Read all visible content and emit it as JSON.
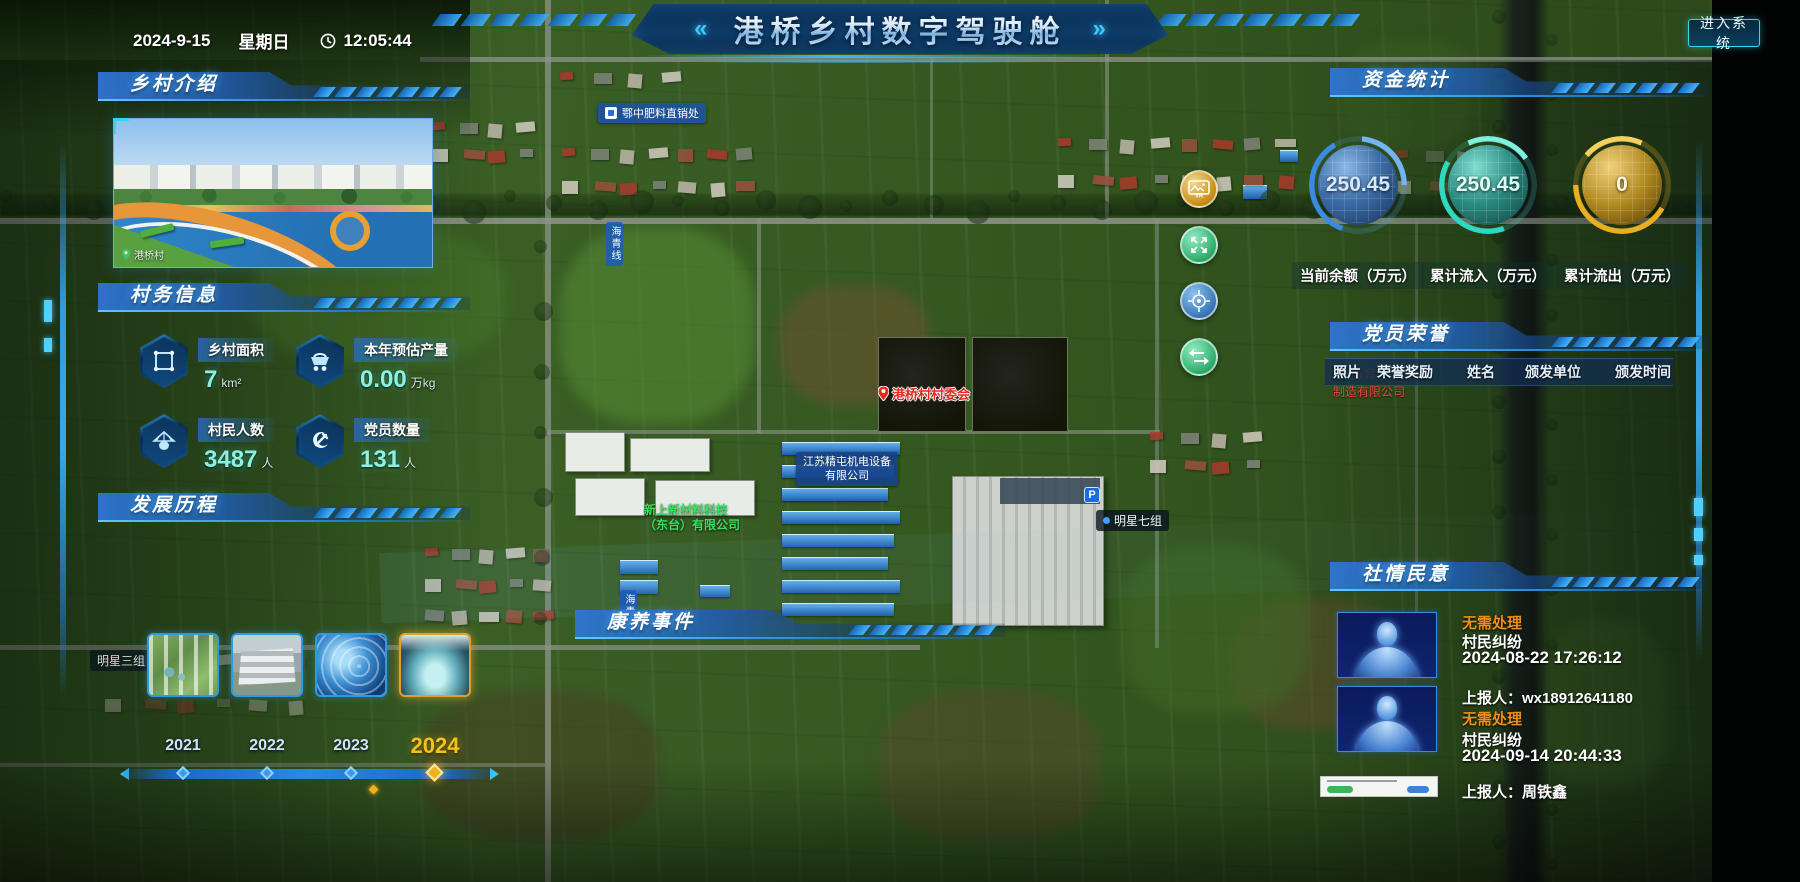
{
  "header": {
    "date": "2024-9-15",
    "weekday": "星期日",
    "time": "12:05:44",
    "title": "港桥乡村数字驾驶舱",
    "title_left_arrow": "«",
    "title_right_arrow": "»",
    "enter_button": "进入系统"
  },
  "panels": {
    "village_intro": {
      "title": "乡村介绍",
      "photo_caption": "港桥村"
    },
    "village_info": {
      "title": "村务信息",
      "stats": [
        {
          "icon": "area-icon",
          "label": "乡村面积",
          "value": "7",
          "unit": "km²"
        },
        {
          "icon": "cart-icon",
          "label": "本年预估产量",
          "value": "0.00",
          "unit": "万kg"
        },
        {
          "icon": "villager-icon",
          "label": "村民人数",
          "value": "3487",
          "unit": "人"
        },
        {
          "icon": "party-icon",
          "label": "党员数量",
          "value": "131",
          "unit": "人"
        }
      ]
    },
    "development": {
      "title": "发展历程",
      "years": [
        {
          "label": "2021",
          "active": false
        },
        {
          "label": "2022",
          "active": false
        },
        {
          "label": "2023",
          "active": false
        },
        {
          "label": "2024",
          "active": true
        }
      ]
    },
    "funds": {
      "title": "资金统计",
      "gauges": [
        {
          "value": "250.45",
          "label": "当前余额（万元）",
          "color": "#3a8ae0"
        },
        {
          "value": "250.45",
          "label": "累计流入（万元）",
          "color": "#2fd8c0"
        },
        {
          "value": "0",
          "label": "累计流出（万元）",
          "color": "#e8b020"
        }
      ]
    },
    "party_honor": {
      "title": "党员荣誉",
      "columns": [
        "照片",
        "荣誉奖励",
        "姓名",
        "颁发单位",
        "颁发时间"
      ]
    },
    "sentiment": {
      "title": "社情民意",
      "items": [
        {
          "status": "无需处理",
          "type": "村民纠纷",
          "time": "2024-08-22 17:26:12",
          "reporter": "上报人：wx18912641180"
        },
        {
          "status": "无需处理",
          "type": "村民纠纷",
          "time": "2024-09-14 20:44:33",
          "reporter": "上报人：周铁鑫"
        }
      ]
    },
    "health_events": {
      "title": "康养事件"
    }
  },
  "map": {
    "poi": {
      "fertilizer_store": "鄂中肥料直销处",
      "village_committee": "港桥村村委会",
      "company_jingtun_line1": "江苏精屯机电设备",
      "company_jingtun_line2": "有限公司",
      "company_xinshang_line1": "新上新材料科技",
      "company_xinshang_line2": "（东台）有限公司",
      "mingxing7": "明星七组",
      "mingxing3": "明星三组",
      "road_name": "海青线",
      "red_company_partial1": "睿智",
      "red_company_partial2": "制造有限公司",
      "parking_badge": "P"
    },
    "controls": {
      "vr_label": "VR"
    }
  },
  "colors": {
    "accent_blue": "#2e9ae0",
    "accent_cyan": "#35d4f0",
    "gold": "#f0b020",
    "status_orange": "#f09018",
    "value_teal": "#8ff0e0"
  }
}
